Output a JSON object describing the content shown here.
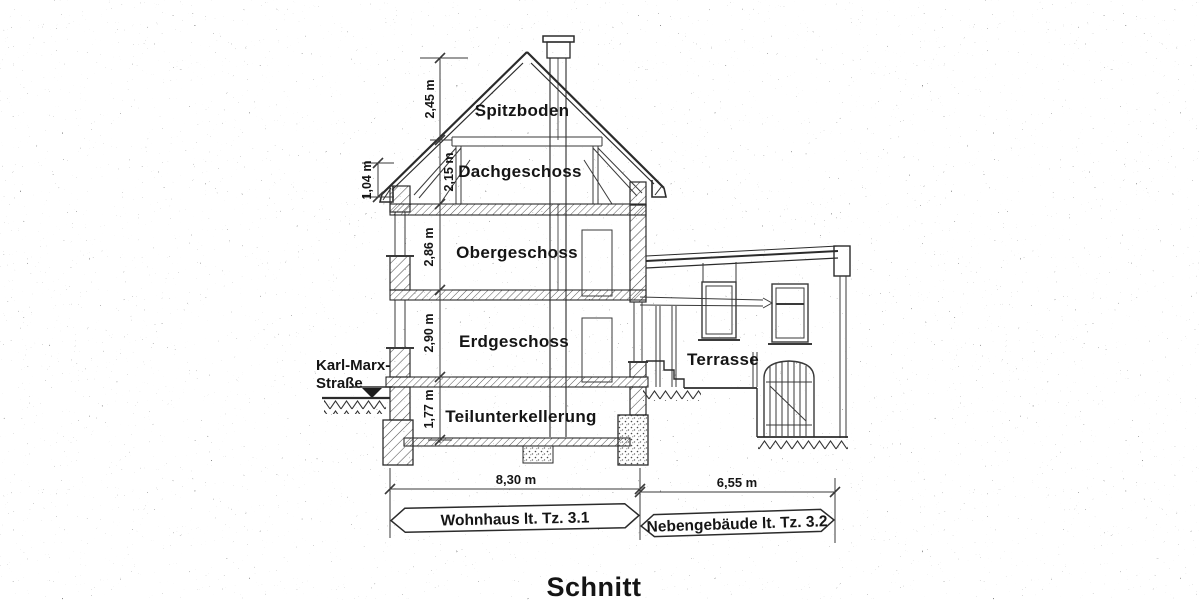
{
  "title": "Schnitt",
  "street": {
    "line1": "Karl-Marx-",
    "line2": "Straße"
  },
  "rooms": {
    "spitzboden": "Spitzboden",
    "dachgeschoss": "Dachgeschoss",
    "obergeschoss": "Obergeschoss",
    "erdgeschoss": "Erdgeschoss",
    "teilunterkellerung": "Teilunterkellerung",
    "terrasse": "Terrasse"
  },
  "dims_v": {
    "spitzboden_height": "2,45 m",
    "knee_wall_height": "1,04 m",
    "dachgeschoss_height": "2,15 m",
    "obergeschoss_height": "2,86 m",
    "erdgeschoss_height": "2,90 m",
    "basement_height": "1,77 m"
  },
  "dims_h": {
    "wohnhaus_width": "8,30 m",
    "nebengebaeude_width": "6,55 m"
  },
  "banners": {
    "wohnhaus": "Wohnhaus lt. Tz. 3.1",
    "nebengebaeude": "Nebengebäude lt. Tz. 3.2"
  },
  "colors": {
    "ink": "#2b2b2b",
    "paper": "#ffffff"
  }
}
